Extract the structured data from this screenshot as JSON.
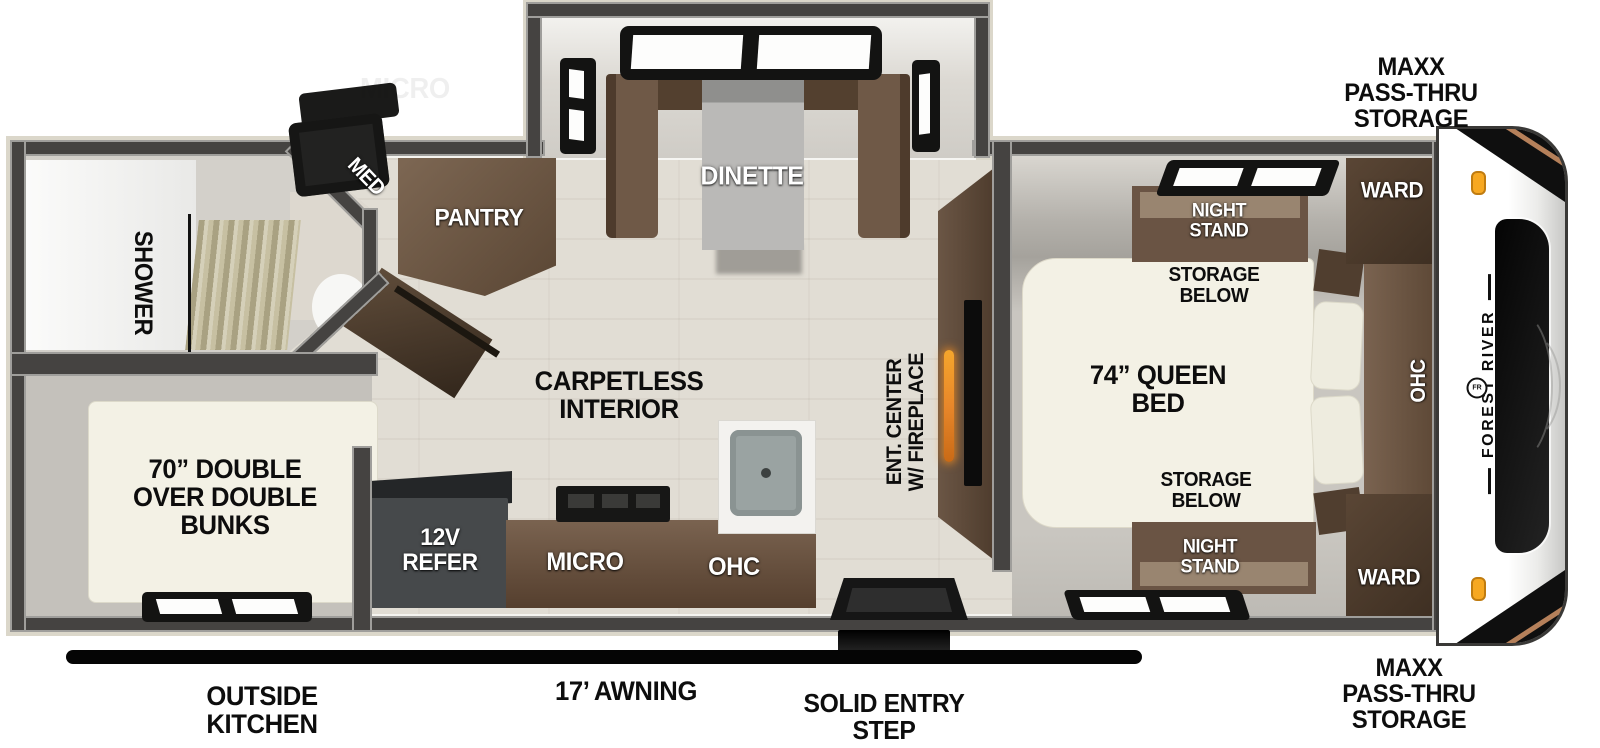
{
  "plan": {
    "exterior": {
      "front_storage": "MAXX\nPASS-THRU\nSTORAGE",
      "outside_kitchen": "OUTSIDE\nKITCHEN",
      "awning": "17’ AWNING",
      "entry_step": "SOLID ENTRY\nSTEP"
    },
    "bedroom": {
      "bed": "74” QUEEN\nBED",
      "night_stand": "NIGHT\nSTAND",
      "storage_below": "STORAGE\nBELOW",
      "ward": "WARD",
      "ohc": "OHC"
    },
    "living": {
      "dinette": "DINETTE",
      "pantry": "PANTRY",
      "interior": "CARPETLESS\nINTERIOR",
      "ent_center": "ENT. CENTER\nW/ FIREPLACE"
    },
    "kitchen": {
      "refer": "12V\nREFER",
      "micro": "MICRO",
      "ohc": "OHC",
      "ghost": "MICRO"
    },
    "bath": {
      "shower": "SHOWER",
      "med": "MED"
    },
    "bunk_room": {
      "bunks": "70” DOUBLE\nOVER DOUBLE\nBUNKS"
    },
    "brand": {
      "name": "FOREST RIVER",
      "logo": "FR"
    },
    "colors": {
      "wall": "#454341",
      "wood_floor": "#e1ddd4",
      "cabinet_brown": "#6e5947",
      "dark_cabinet": "#4a3a2c",
      "mattress": "#f3f1e5",
      "flame": "#e8872a",
      "marker_light": "#f7a821",
      "label_black": "#0d0d0d",
      "label_white": "#ffffff"
    }
  }
}
